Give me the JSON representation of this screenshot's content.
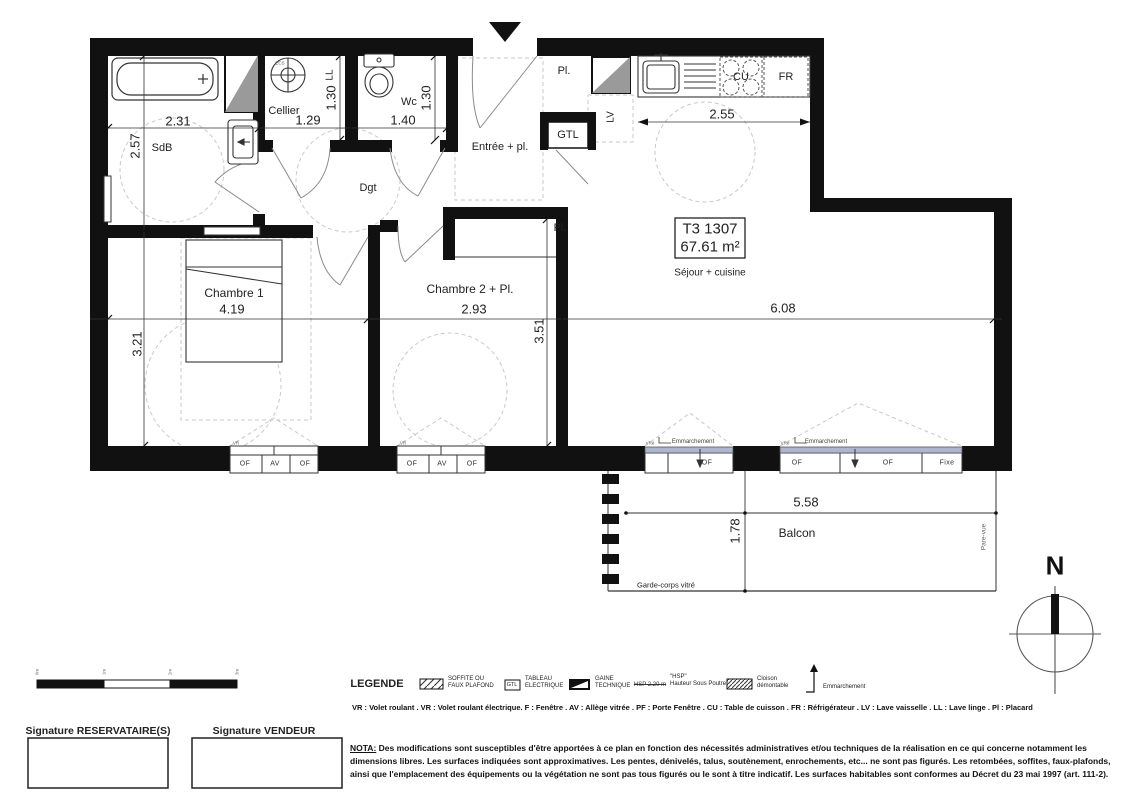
{
  "plan": {
    "unit_box": {
      "unit": "T3 1307",
      "area": "67.61 m²"
    },
    "rooms": {
      "sdb": "SdB",
      "cellier": "Cellier",
      "wc": "Wc",
      "entree": "Entrée + pl.",
      "dgt": "Dgt",
      "pl_entry": "Pl.",
      "gtl": "GTL",
      "lv": "LV",
      "ll": "LL",
      "ecs": "ECS",
      "cu": "CU",
      "fr": "FR",
      "sejour": "Séjour + cuisine",
      "chambre1": "Chambre 1",
      "chambre2": "Chambre 2 + Pl.",
      "pl_ch2": "Pl.",
      "balcon": "Balcon",
      "garde_corps": "Garde-corps vitré",
      "pare_vue": "Pare-vue"
    },
    "dims": {
      "sdb_w": "2.31",
      "sdb_h": "2.57",
      "cellier_w": "1.29",
      "cellier_h": "1.30",
      "wc_w": "1.40",
      "wc_h": "1.30",
      "kitchen_w": "2.55",
      "ch1_w": "4.19",
      "ch1_h": "3.21",
      "ch2_w": "2.93",
      "ch2_h": "3.51",
      "sejour_w": "6.08",
      "balcon_w": "5.58",
      "balcon_d": "1.78"
    },
    "windows": {
      "ch1": {
        "vr": "VR",
        "labels": [
          "OF",
          "AV",
          "OF"
        ]
      },
      "ch2": {
        "vr": "VR",
        "labels": [
          "OF",
          "AV",
          "OF"
        ]
      },
      "sejour_small": {
        "vr": "VRé",
        "step": "Emmarchement",
        "labels": [
          "OF"
        ]
      },
      "sejour_large": {
        "vr": "VRé",
        "step": "Emmarchement",
        "labels": [
          "OF",
          "OF",
          "Fixe"
        ]
      }
    },
    "compass_n": "N"
  },
  "scale_bar": {
    "labels": [
      "0m",
      "1m",
      "2m",
      "3m"
    ]
  },
  "legend": {
    "title": "LEGENDE",
    "items": [
      {
        "line1": "SOFFITE OU",
        "line2": "FAUX PLAFOND"
      },
      {
        "symbol": "GTL",
        "line1": "TABLEAU",
        "line2": "ELECTRIQUE"
      },
      {
        "line1": "GAINE",
        "line2": "TECHNIQUE"
      },
      {
        "sample": "HSP 2.20 m",
        "line1": "\"HSP\"",
        "line2": "Hauteur Sous Poutre"
      },
      {
        "line1": "Cloison",
        "line2": "démontable"
      },
      {
        "line1": "Emmarchement",
        "line2": ""
      }
    ],
    "abbreviations": "VR : Volet roulant . VR : Volet roulant électrique. F : Fenêtre . AV : Allège vitrée . PF : Porte Fenêtre . CU : Table de cuisson . FR : Réfrigérateur . LV : Lave vaisselle . LL : Lave linge . Pl : Placard"
  },
  "footer": {
    "signature_reservataire": "Signature RESERVATAIRE(S)",
    "signature_vendeur": "Signature VENDEUR",
    "nota_label": "NOTA:",
    "nota_text": "Des modifications sont susceptibles d'être apportées à ce plan en fonction des nécessités administratives et/ou techniques de la réalisation en ce qui concerne notamment les dimensions libres. Les surfaces indiquées sont approximatives. Les pentes, dénivelés, talus, soutènement, enrochements, etc... ne sont pas figurés. Les retombées, soffites, faux-plafonds, ainsi que l'emplacement des équipements ou la végétation ne sont pas tous figurés ou le sont à titre indicatif. Les surfaces habitables sont conformes au Décret du 23 mai 1997 (art. 111-2)."
  }
}
